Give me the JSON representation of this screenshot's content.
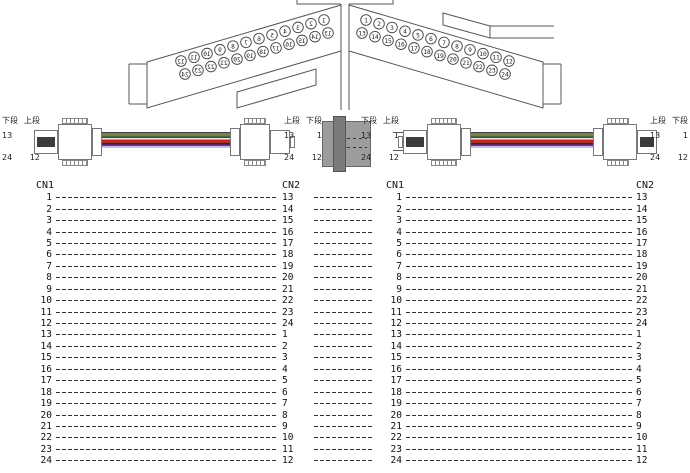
{
  "connector_faces": {
    "left": {
      "row_upper": [
        "12",
        "11",
        "10",
        "9",
        "8",
        "7",
        "6",
        "5",
        "4",
        "3",
        "2",
        "1"
      ],
      "row_lower": [
        "24",
        "23",
        "22",
        "21",
        "20",
        "19",
        "18",
        "17",
        "16",
        "15",
        "14",
        "13"
      ],
      "mirrored": true
    },
    "right": {
      "row_upper": [
        "1",
        "2",
        "3",
        "4",
        "5",
        "6",
        "7",
        "8",
        "9",
        "10",
        "11",
        "12"
      ],
      "row_lower": [
        "13",
        "14",
        "15",
        "16",
        "17",
        "18",
        "19",
        "20",
        "21",
        "22",
        "23",
        "24"
      ],
      "mirrored": false
    }
  },
  "cable_assemblies": [
    {
      "left_end": {
        "col_left_label": "下段",
        "col_right_label": "上段",
        "upper_left": "13",
        "upper_right": "1",
        "lower_left": "24",
        "lower_right": "12"
      },
      "right_end": {
        "col_left_label": "上段",
        "col_right_label": "下段",
        "upper_left": "13",
        "upper_right": "1",
        "lower_left": "24",
        "lower_right": "12"
      }
    },
    {
      "left_end": {
        "col_left_label": "下段",
        "col_right_label": "上段",
        "upper_left": "13",
        "upper_right": "1",
        "lower_left": "24",
        "lower_right": "12"
      },
      "right_end": {
        "col_left_label": "上段",
        "col_right_label": "下段",
        "upper_left": "13",
        "upper_right": "1",
        "lower_left": "24",
        "lower_right": "12"
      }
    }
  ],
  "ribbon_stripes": [
    {
      "color": "#3b3f52",
      "h": 1
    },
    {
      "color": "#76814f",
      "h": 3.5
    },
    {
      "color": "#2c5029",
      "h": 1.5
    },
    {
      "color": "#eeeeee",
      "h": 1.5
    },
    {
      "color": "#bb2a22",
      "h": 3.5
    },
    {
      "color": "#5d1616",
      "h": 1.5
    },
    {
      "color": "#6b3190",
      "h": 1.5
    },
    {
      "color": "#c9bde2",
      "h": 2
    }
  ],
  "diagram_colors": {
    "line": "#555",
    "coupler_body": "#9c9c9c",
    "coupler_bar": "#7b7b7b",
    "boot_band": "#3c3c3c"
  },
  "tables": [
    {
      "header_left": "CN1",
      "header_right": "CN2",
      "rows": [
        [
          "1",
          "13"
        ],
        [
          "2",
          "14"
        ],
        [
          "3",
          "15"
        ],
        [
          "4",
          "16"
        ],
        [
          "5",
          "17"
        ],
        [
          "6",
          "18"
        ],
        [
          "7",
          "19"
        ],
        [
          "8",
          "20"
        ],
        [
          "9",
          "21"
        ],
        [
          "10",
          "22"
        ],
        [
          "11",
          "23"
        ],
        [
          "12",
          "24"
        ],
        [
          "13",
          "1"
        ],
        [
          "14",
          "2"
        ],
        [
          "15",
          "3"
        ],
        [
          "16",
          "4"
        ],
        [
          "17",
          "5"
        ],
        [
          "18",
          "6"
        ],
        [
          "19",
          "7"
        ],
        [
          "20",
          "8"
        ],
        [
          "21",
          "9"
        ],
        [
          "22",
          "10"
        ],
        [
          "23",
          "11"
        ],
        [
          "24",
          "12"
        ]
      ]
    },
    {
      "header_left": "CN1",
      "header_right": "CN2",
      "rows": [
        [
          "1",
          "13"
        ],
        [
          "2",
          "14"
        ],
        [
          "3",
          "15"
        ],
        [
          "4",
          "16"
        ],
        [
          "5",
          "17"
        ],
        [
          "6",
          "18"
        ],
        [
          "7",
          "19"
        ],
        [
          "8",
          "20"
        ],
        [
          "9",
          "21"
        ],
        [
          "10",
          "22"
        ],
        [
          "11",
          "23"
        ],
        [
          "12",
          "24"
        ],
        [
          "13",
          "1"
        ],
        [
          "14",
          "2"
        ],
        [
          "15",
          "3"
        ],
        [
          "16",
          "4"
        ],
        [
          "17",
          "5"
        ],
        [
          "18",
          "6"
        ],
        [
          "19",
          "7"
        ],
        [
          "20",
          "8"
        ],
        [
          "21",
          "9"
        ],
        [
          "22",
          "10"
        ],
        [
          "23",
          "11"
        ],
        [
          "24",
          "12"
        ]
      ]
    }
  ]
}
